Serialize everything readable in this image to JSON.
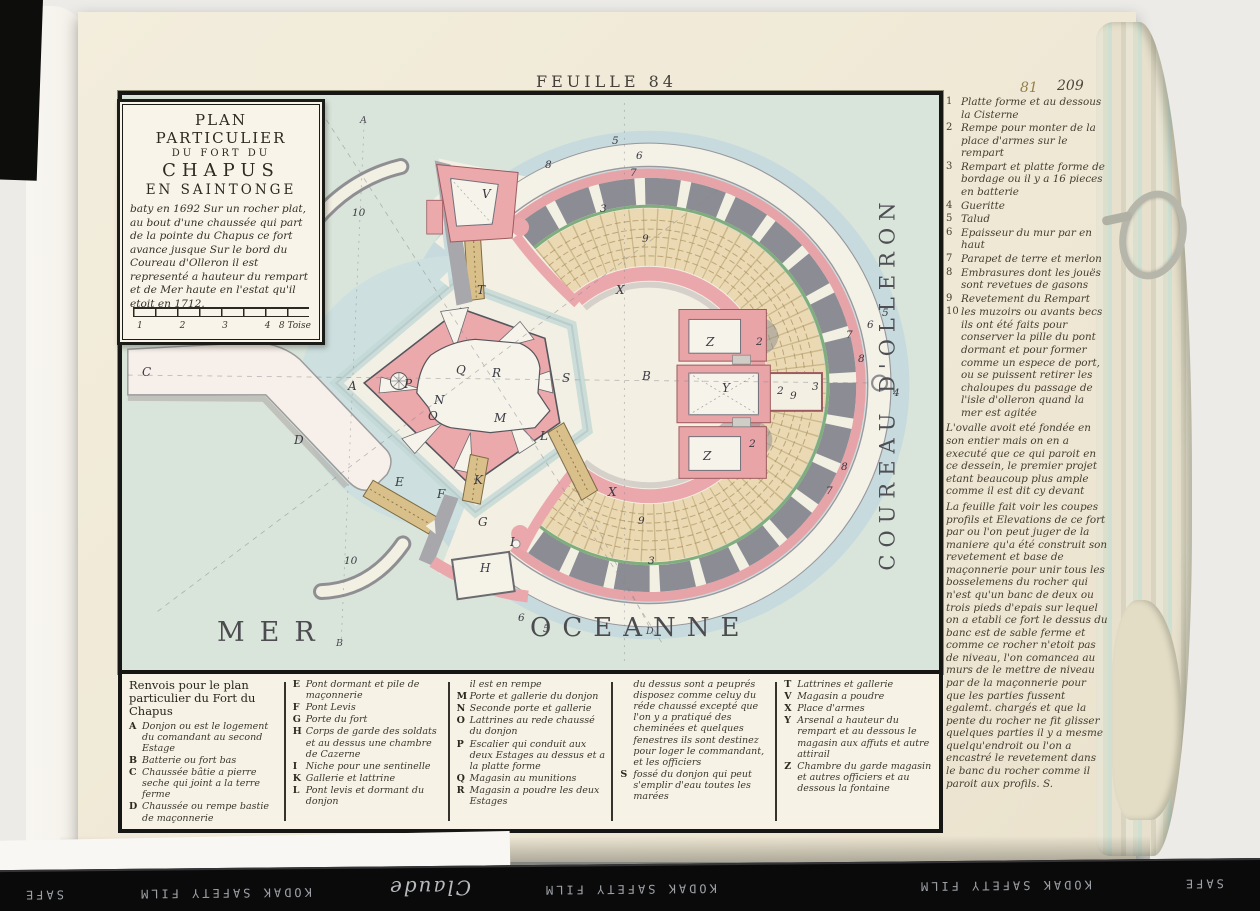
{
  "page": {
    "feuille": "FEUILLE 84",
    "folio_stamp": "81",
    "folio_ink": "209"
  },
  "cartouche": {
    "title_line1": "PLAN PARTICULIER",
    "title_line2": "DU FORT DU",
    "title_line3": "CHAPUS",
    "title_line4": "EN SAINTONGE",
    "description": "baty en 1692 Sur un rocher plat, au bout d'une chaussée qui part de la pointe du Chapus ce fort avance jusque Sur le bord du Coureau d'Olleron il est representé a hauteur du rempart et de Mer haute en l'estat qu'il etoit en 1712.",
    "scale_ticks": "1 2 3 4",
    "scale_label": "8 Toise"
  },
  "map": {
    "sea_label_1": "MER",
    "sea_label_2": "OCEANNE",
    "channel_label": "COUREAU  D'OLLERON",
    "letters": {
      "a_top": "A",
      "a": "A",
      "b": "B",
      "b2": "B",
      "c": "C",
      "d": "D",
      "d2": "D",
      "e": "E",
      "f": "F",
      "g": "G",
      "h": "H",
      "i": "I",
      "k": "K",
      "l": "L",
      "m": "M",
      "n": "N",
      "o": "O",
      "p": "P",
      "q": "Q",
      "r": "R",
      "s": "S",
      "t": "T",
      "v": "V",
      "x1": "X",
      "x2": "X",
      "y": "Y",
      "z1": "Z",
      "z2": "Z"
    },
    "numbers": {
      "n2a": "2",
      "n2b": "2",
      "n2c": "2",
      "n3a": "3",
      "n3b": "3",
      "n3c": "3",
      "n4": "4",
      "n5a": "5",
      "n5b": "5",
      "n5c": "5",
      "n6a": "6",
      "n6b": "6",
      "n6c": "6",
      "n7a": "7",
      "n7b": "7",
      "n7c": "7",
      "n8a": "8",
      "n8b": "8",
      "n8c": "8",
      "n9a": "9",
      "n9b": "9",
      "n9c": "9",
      "n10a": "10",
      "n10b": "10"
    }
  },
  "legend_right": {
    "entries": [
      {
        "num": "1",
        "text": "Platte forme et au dessous la Cisterne"
      },
      {
        "num": "2",
        "text": "Rempe pour monter de la place d'armes sur le rempart"
      },
      {
        "num": "3",
        "text": "Rempart et platte forme de bordage ou il y a 16 pieces en batterie"
      },
      {
        "num": "4",
        "text": "Gueritte"
      },
      {
        "num": "5",
        "text": "Talud"
      },
      {
        "num": "6",
        "text": "Epaisseur du mur par en haut"
      },
      {
        "num": "7",
        "text": "Parapet de terre et merlon"
      },
      {
        "num": "8",
        "text": "Embrasures dont les jouës sont revetues de gasons"
      },
      {
        "num": "9",
        "text": "Revetement du Rempart"
      },
      {
        "num": "10",
        "text": "les muzoirs ou avants becs ils ont été faits pour conserver la pille du pont dormant et pour former comme un espece de port, ou se puissent retirer les chaloupes du passage de l'isle d'olleron quand la mer est agitée"
      }
    ],
    "para1": "L'ovalle avoit eté fondée en son entier mais on en a executé que ce qui paroit en ce dessein, le premier projet etant beaucoup plus ample comme il est dit cy devant",
    "para2": "La feuille      fait voir les coupes profils et Elevations de ce fort par ou l'on peut juger de la maniere qu'a été construit son revetement et base de maçonnerie pour unir tous les bosselemens du rocher qui n'est qu'un banc de deux ou trois pieds d'epais sur lequel on a etabli ce fort le dessus du banc est de sable ferme et comme ce rocher n'etoit pas de niveau, l'on comancea au murs de le mettre de niveau par de la maçonnerie pour que les parties fussent egalemt. chargés et que la pente du rocher ne fit glisser quelques parties il y a mesme quelqu'endroit ou l'on a encastré le revetement dans le banc du rocher comme il paroit aux profils. S."
  },
  "legend_bottom": {
    "header": "Renvois pour le plan particulier du Fort du Chapus",
    "col1": [
      {
        "letter": "A",
        "text": "Donjon ou est le logement du comandant au second Estage"
      },
      {
        "letter": "B",
        "text": "Batterie ou fort bas"
      },
      {
        "letter": "C",
        "text": "Chaussée bâtie a pierre seche qui joint a la terre ferme"
      },
      {
        "letter": "D",
        "text": "Chaussée ou rempe bastie de maçonnerie"
      }
    ],
    "col2": [
      {
        "letter": "E",
        "text": "Pont dormant et pile de maçonnerie"
      },
      {
        "letter": "F",
        "text": "Pont Levis"
      },
      {
        "letter": "G",
        "text": "Porte du fort"
      },
      {
        "letter": "H",
        "text": "Corps de garde des soldats et au dessus une chambre de Cazerne"
      },
      {
        "letter": "I",
        "text": "Niche pour une sentinelle"
      },
      {
        "letter": "K",
        "text": "Gallerie et lattrine"
      },
      {
        "letter": "L",
        "text": "Pont levis et dormant du donjon"
      }
    ],
    "col3": [
      {
        "letter": "",
        "text": "il est en rempe"
      },
      {
        "letter": "M",
        "text": "Porte et gallerie du donjon"
      },
      {
        "letter": "N",
        "text": "Seconde porte et gallerie"
      },
      {
        "letter": "O",
        "text": "Lattrines au rede chaussé du donjon"
      },
      {
        "letter": "P",
        "text": "Escalier qui conduit aux deux Estages au dessus et a la platte forme"
      },
      {
        "letter": "Q",
        "text": "Magasin au munitions"
      },
      {
        "letter": "R",
        "text": "Magasin a poudre les deux Estages"
      }
    ],
    "col4": [
      {
        "letter": "",
        "text": "du dessus sont a peuprés disposez comme celuy du réde chaussé excepté que l'on y a pratiqué des cheminées et quelques fenestres ils sont destinez pour loger le commandant, et les officiers"
      },
      {
        "letter": "S",
        "text": "fossé du donjon qui peut s'emplir d'eau toutes les marées"
      }
    ],
    "col5": [
      {
        "letter": "T",
        "text": "Lattrines et gallerie"
      },
      {
        "letter": "V",
        "text": "Magasin a poudre"
      },
      {
        "letter": "X",
        "text": "Place d'armes"
      },
      {
        "letter": "Y",
        "text": "Arsenal a hauteur du rempart et au dessous le magasin aux affuts et autre attirail"
      },
      {
        "letter": "Z",
        "text": "Chambre du garde magasin et autres officiers et au dessous la fontaine"
      }
    ]
  },
  "film_strip": {
    "fragments": [
      "SAFE",
      "KODAK SAFETY FILM",
      "Claude",
      "KODAK SAFETY FILM",
      "KODAK SAFETY FILM",
      "SAFE"
    ]
  }
}
